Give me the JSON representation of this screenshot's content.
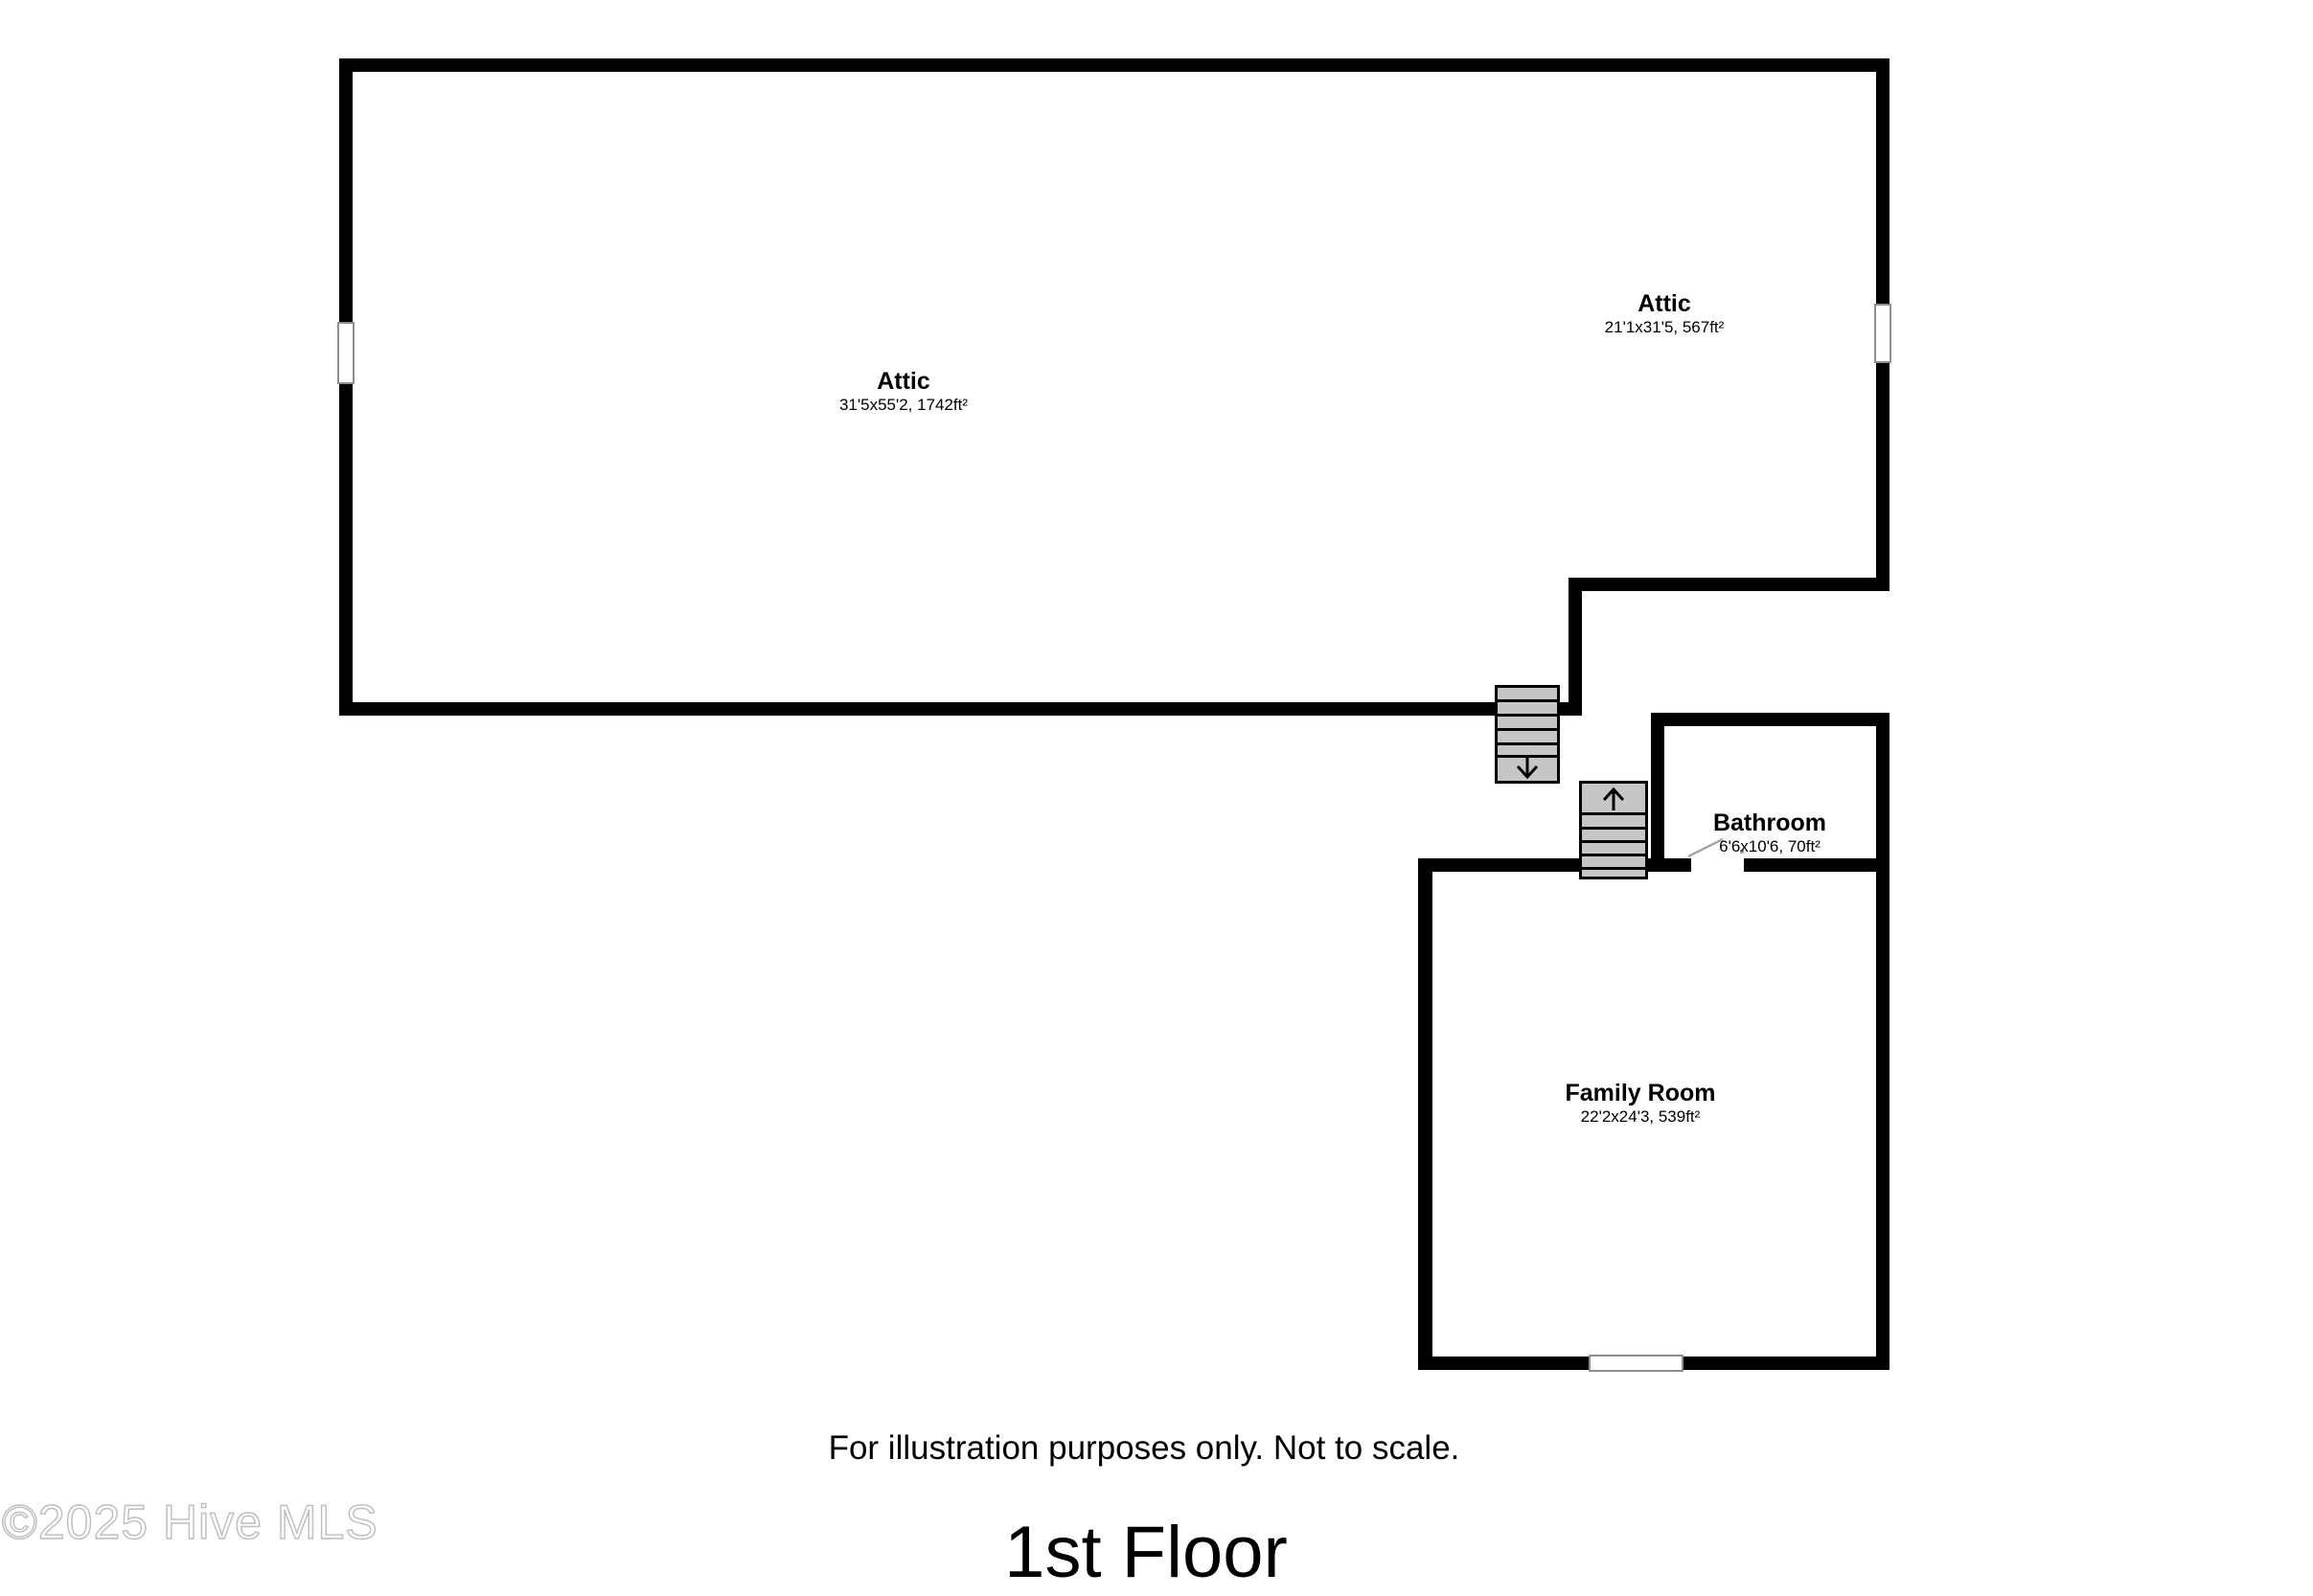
{
  "floor": {
    "title": "1st Floor",
    "disclaimer": "For illustration purposes only. Not to scale."
  },
  "watermark": "©2025 Hive MLS",
  "rooms": {
    "attic_main": {
      "name": "Attic",
      "dims": "31'5x55'2, 1742ft²"
    },
    "attic_small": {
      "name": "Attic",
      "dims": "21'1x31'5, 567ft²"
    },
    "bathroom": {
      "name": "Bathroom",
      "dims": "6'6x10'6, 70ft²"
    },
    "family_room": {
      "name": "Family Room",
      "dims": "22'2x24'3, 539ft²"
    }
  },
  "stairs": {
    "down": {
      "direction": "down"
    },
    "up": {
      "direction": "up"
    }
  },
  "colors": {
    "wall": "#000000",
    "stair_fill": "#c6c6c6",
    "window_border": "#8f8f8f",
    "leader_line": "#a6a6a6",
    "watermark_outline": "#bdbdbd"
  }
}
